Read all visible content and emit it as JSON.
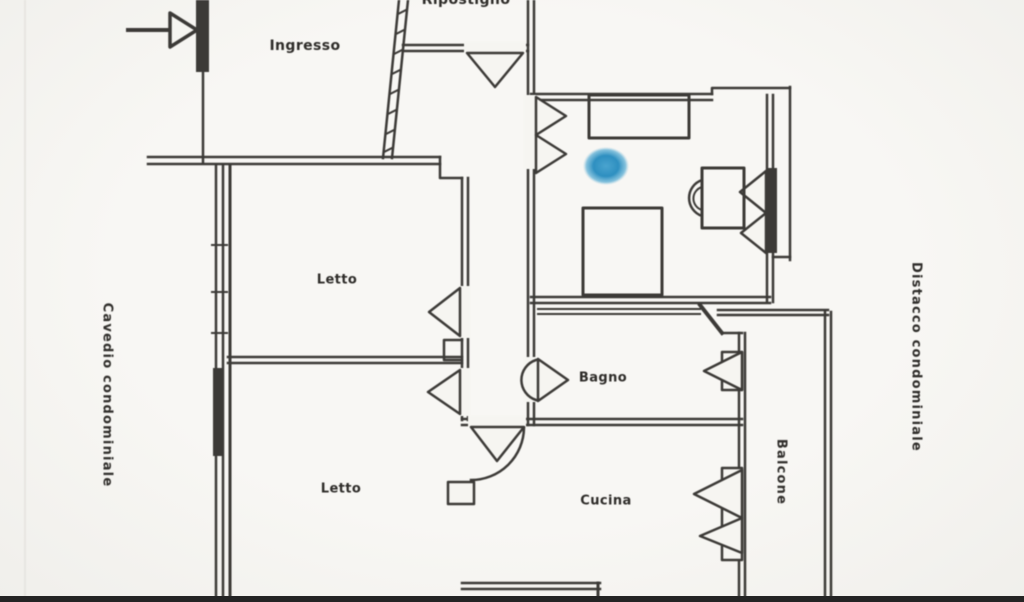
{
  "floorplan": {
    "rooms": {
      "ingresso": {
        "label": "Ingresso"
      },
      "ripostiglio": {
        "label": "Ripostiglio"
      },
      "letto1": {
        "label": "Letto"
      },
      "letto2": {
        "label": "Letto"
      },
      "bagno": {
        "label": "Bagno"
      },
      "cucina": {
        "label": "Cucina"
      }
    },
    "outdoor": {
      "balcone": {
        "label": "Balcone"
      },
      "left_shaft": {
        "label": "Cavedio condominiale"
      },
      "right_setback": {
        "label": "Distacco condominiale"
      }
    },
    "colors": {
      "wall": "#3c3a37",
      "background": "#f6f5f1",
      "marker_blue": "#2e8fc0"
    }
  }
}
